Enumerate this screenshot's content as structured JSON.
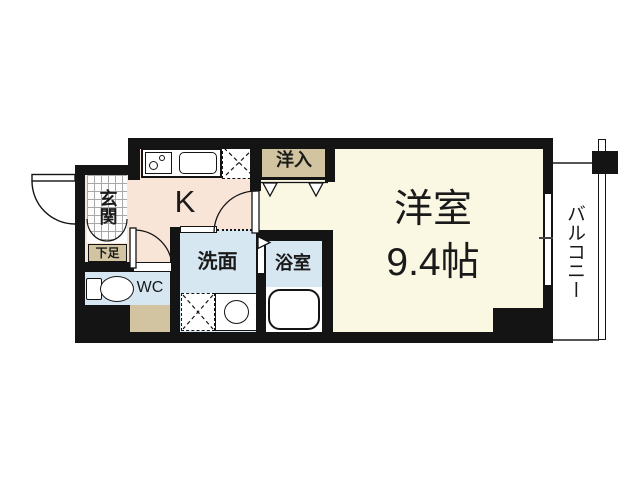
{
  "floorplan": {
    "rooms": {
      "entrance": "玄関",
      "shoe_cabinet": "下足",
      "kitchen": "K",
      "toilet": "WC",
      "washroom": "洗面",
      "bathroom": "浴室",
      "closet": "洋入",
      "living_room": "洋室",
      "living_room_size": "9.4帖",
      "balcony": "バルコニー"
    },
    "colors": {
      "wall": "#141414",
      "living_floor": "#faf7e3",
      "kitchen_floor": "#f9e4d8",
      "wet_floor": "#d7e7f2",
      "storage": "#d2c4a0",
      "fixture_outline": "#141414"
    },
    "fixtures": [
      "stove",
      "sink",
      "refrigerator-space",
      "closet-bifold-door",
      "washing-machine-space",
      "washbasin",
      "bathtub",
      "toilet",
      "entrance-door",
      "room-door",
      "wc-door",
      "bath-door",
      "balcony-window",
      "balcony-railing"
    ]
  }
}
